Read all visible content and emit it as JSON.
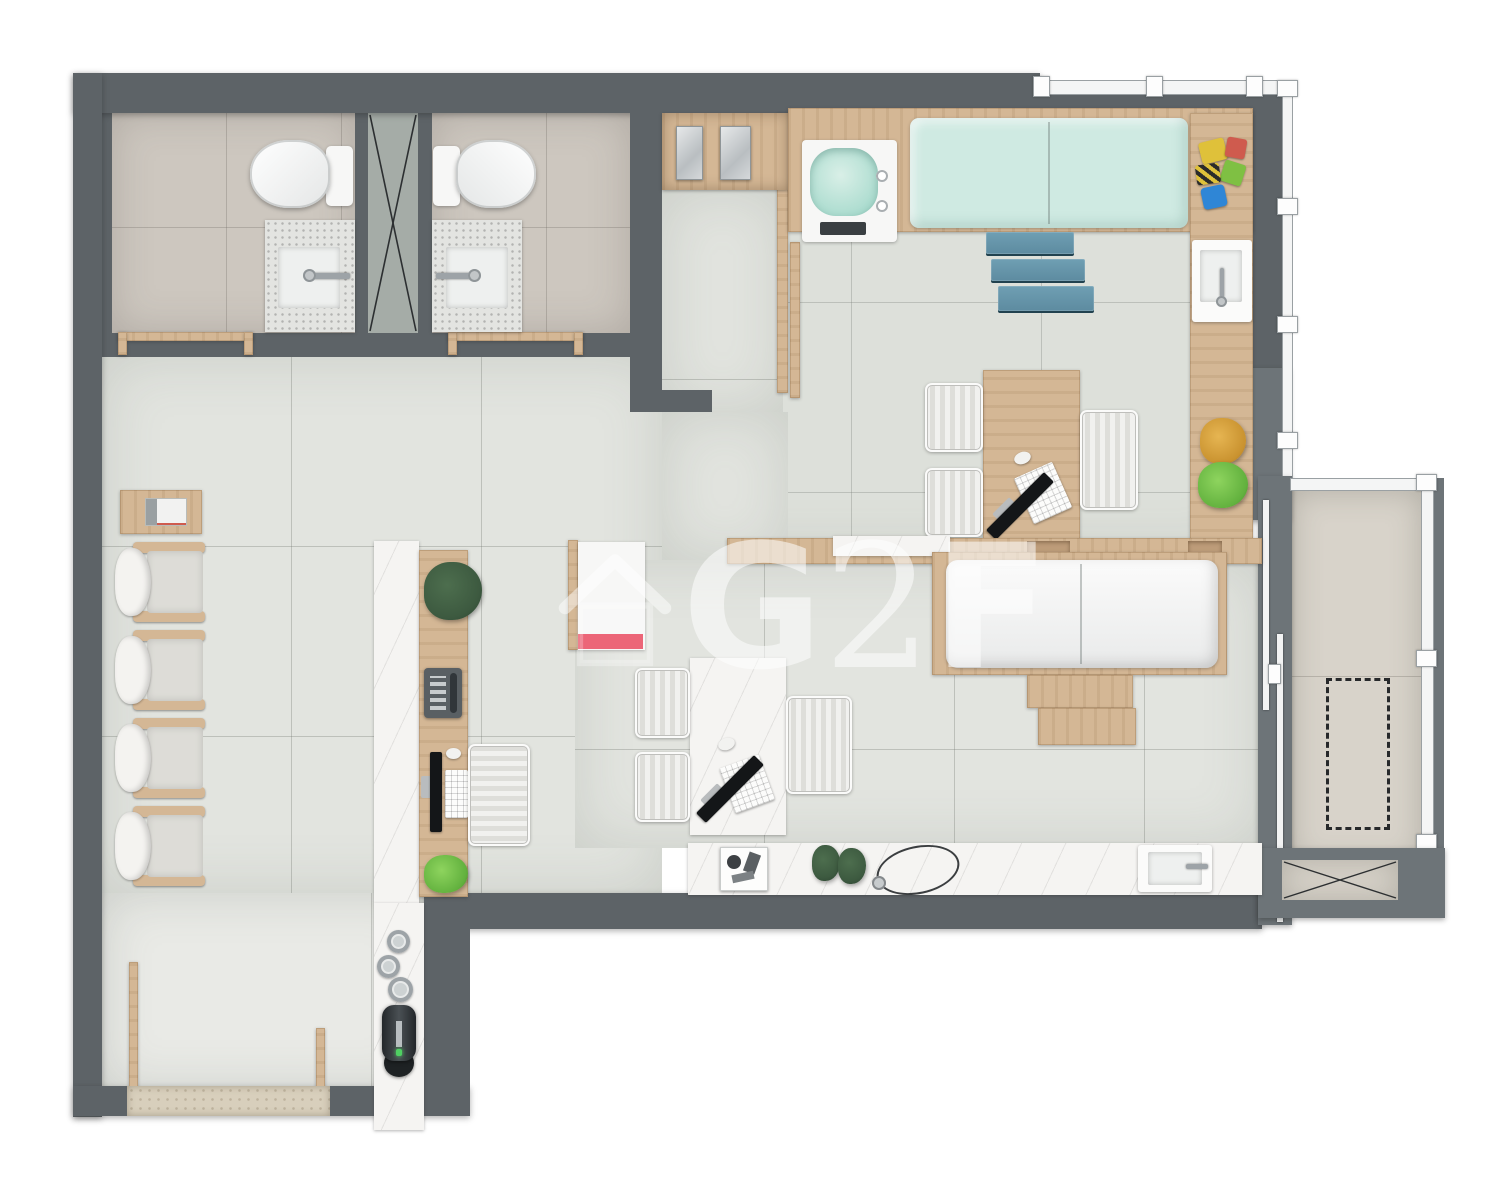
{
  "watermark": {
    "letters": [
      "G",
      "2",
      "F"
    ],
    "icon": "house-icon",
    "color": "#ffffff",
    "opacity": 0.55
  },
  "colors": {
    "wall": "#5d6367",
    "wall2": "#6d7478",
    "floor": "#e2e4df",
    "floorBath": "#cdc7bf",
    "floorPed": "#dde0da",
    "floorWing": "#e9eae6",
    "floorBalc": "#d8d3ca",
    "shaft": "#a5aca7",
    "wood": "#d4b795",
    "wood2": "#bd9c79",
    "marble": "#f5f4f2",
    "granite": "#e3e4e1",
    "teal": "#cfeae2",
    "mint": "#abdccf",
    "steps": "#6f9fb3",
    "red": "#e8485e",
    "metal": "#9da3a7",
    "cushion": "#dddcd7",
    "chairLight": "#f1f1ef",
    "plantDark": "#3d5a40",
    "plantBright": "#62b13e",
    "amber": "#c9922f",
    "machine": "#2c3134",
    "glaze": "#f4f5f5",
    "frame": "#9aa0a3",
    "toyY": "#dfc13a",
    "toyG": "#7fc043",
    "toyB": "#2f86d6",
    "toyR": "#cf5b4e",
    "mat": "#d8cfbc",
    "white": "#f7f7f6",
    "dark": "#2a2d2f"
  }
}
